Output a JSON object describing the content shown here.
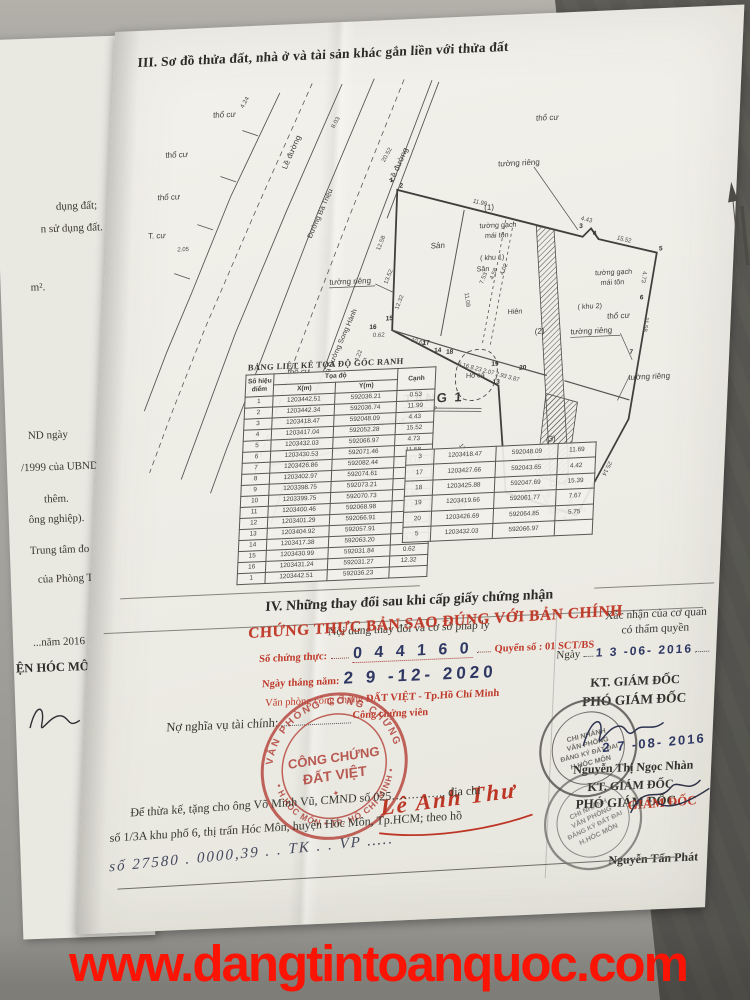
{
  "photo": {
    "watermark": "www.dangtintoanquoc.com"
  },
  "under_page": {
    "fragments": [
      "dụng đất;",
      "n sử dụng đất.",
      "m².",
      "ND ngày",
      "/1999 của UBND",
      "thêm.",
      "ông nghiệp).",
      "Trung tâm đo đạc",
      "của Phòng Tài",
      "...năm 2016",
      "ỆN HÓC MÔN"
    ]
  },
  "section3": {
    "title": "III. Sơ đồ thửa đất, nhà ở và tài sản khác gắn liền với thửa đất",
    "diagram": {
      "labels": {
        "tho_cu": "thổ cư",
        "t_cu": "T. cư",
        "le_duong": "Lề đường",
        "duong_ba_trieu": "Đường Bà Triệu",
        "ra_duong": "Ra Đường Song Hành",
        "san": "Sân",
        "hien": "Hiên",
        "ho_ca": "Hồ cá",
        "khu1_no": "(1)",
        "khu2_no": "(2)",
        "khu3_no": "(3)",
        "khu1": "( khu 1)",
        "khu2": "( khu 2)",
        "tuong_gach": "tường gạch",
        "mai_ton": "mái tôn",
        "tuong_rieng": "tường riêng",
        "tang1": "TẦNG 1"
      },
      "dims": [
        "4.24",
        "8.03",
        "20.52",
        "2.05",
        "11.99",
        "4.43",
        "15.52",
        "4.73",
        "11.58",
        "25.14",
        "12.58",
        "13.52",
        "12.32",
        "4.22",
        "10.62",
        "11.09",
        "7.53",
        "4.58",
        "4.02",
        "14.18",
        "13.54",
        "9.71",
        "0.62",
        "4.64",
        "2.23",
        "1.90",
        "2.67",
        "5.16 8.23 2.07 2.93 3.87"
      ],
      "points": [
        "1",
        "2",
        "3",
        "4",
        "5",
        "6",
        "7",
        "8",
        "9",
        "12",
        "13",
        "14",
        "15",
        "16",
        "17",
        "18",
        "19",
        "20"
      ]
    },
    "coords_table": {
      "title": "BẢNG LIỆT KÊ TỌA ĐỘ GỐC RANH",
      "col_point": "Số hiệu điểm",
      "col_coords": "Tọa độ",
      "col_x": "X(m)",
      "col_y": "Y(m)",
      "col_edge": "Cạnh",
      "rows": [
        [
          "1",
          "1203442.51",
          "592036.21",
          "0.53"
        ],
        [
          "2",
          "1203442.34",
          "592036.74",
          "11.99"
        ],
        [
          "3",
          "1203418.47",
          "592048.09",
          "4.43"
        ],
        [
          "4",
          "1203417.04",
          "592052.28",
          "15.52"
        ],
        [
          "5",
          "1203432.03",
          "592066.97",
          "4.73"
        ],
        [
          "6",
          "1203430.53",
          "592071.46",
          "11.58"
        ],
        [
          "7",
          "1203426.86",
          "592082.44",
          "25.14"
        ],
        [
          "8",
          "1203402.97",
          "592074.61",
          "4.64"
        ],
        [
          "9",
          "1203398.75",
          "592073.21",
          "2.67"
        ],
        [
          "10",
          "1203399.75",
          "592070.73",
          "1.90"
        ],
        [
          "11",
          "1203400.46",
          "592068.98",
          "2.23"
        ],
        [
          "12",
          "1203401.29",
          "592066.91",
          "9.71"
        ],
        [
          "13",
          "1203404.92",
          "592057.91",
          "13.54"
        ],
        [
          "14",
          "1203417.38",
          "592063.20",
          "14.18"
        ],
        [
          "15",
          "1203430.99",
          "592031.84",
          "0.62"
        ],
        [
          "16",
          "1203431.24",
          "592031.27",
          "12.32"
        ],
        [
          "1",
          "1203442.51",
          "592036.23",
          ""
        ]
      ],
      "rows2": [
        [
          "3",
          "1203418.47",
          "592048.09",
          "11.69"
        ],
        [
          "17",
          "1203427.66",
          "592043.65",
          "4.42"
        ],
        [
          "18",
          "1203425.88",
          "592047.69",
          "15.39"
        ],
        [
          "19",
          "1203419.66",
          "592061.77",
          "7.67"
        ],
        [
          "20",
          "1203426.69",
          "592064.85",
          "5.75"
        ],
        [
          "5",
          "1203432.03",
          "592066.97",
          ""
        ]
      ]
    }
  },
  "section4": {
    "title": "IV. Những thay đổi sau khi cấp giấy chứng nhận",
    "left_header": "Nội dung thay đổi và cơ sở pháp lý",
    "right_header_1": "Xác nhận của cơ quan",
    "right_header_2": "có thẩm quyền",
    "notary": {
      "line1": "CHỨNG THỰC BẢN SAO ĐÚNG VỚI BẢN CHÍNH",
      "so_ct_label": "Số chứng thực:",
      "so_ct_value": "0 4 4 1 6 0",
      "quyen_so": "Quyển số : 01 SCT/BS",
      "ngay_label": "Ngày tháng năm:",
      "ngay_value": "2 9  -12-  2020",
      "office_pre": "Văn phòng công chứng ",
      "office_bold": "ĐẤT VIỆT - Tp.Hồ Chí Minh",
      "ccv": "Công chứng viên",
      "stamp_arc_top": "VĂN PHÒNG CÔNG CHỨNG",
      "stamp_arc_bottom": "• H.HÓC MÔN • TP. HỒ CHÍ MINH •",
      "stamp_center1": "CÔNG CHỨNG",
      "stamp_center2": "ĐẤT VIỆT",
      "stamp_star": "✦",
      "signature_name": "Lê Anh Thư"
    },
    "finance_label": "Nợ nghĩa vụ tài chính:",
    "authority": {
      "date1_label": "Ngày",
      "date1_value": "1 3  -06-  2016",
      "kt_giam_doc": "KT. GIÁM ĐỐC",
      "pho_giam_doc": "PHÓ GIÁM ĐỐC",
      "stamp_lines": [
        "CHI NHÁNH",
        "VĂN PHÒNG",
        "ĐĂNG KÝ ĐẤT ĐAI",
        "H.HÓC MÔN"
      ],
      "date2_value": "2 7  -08-  2016",
      "name1": "Nguyễn Thị Ngọc Nhàn",
      "kt_giam_doc2": "KT. GIÁM ĐỐC",
      "pho_giam_doc2": "PHÓ GIÁM ĐỐC",
      "giam_doc_red": "GIÁM ĐỐC",
      "name2": "Nguyễn Tấn Phát"
    },
    "transfer_note_1": "Để thừa kế, tặng cho ông Võ Minh Vũ, CMND số 025…………., địa chỉ",
    "transfer_note_2": "số 1/3A khu phố 6, thị trấn Hóc Môn, huyện Hóc Môn, Tp.HCM; theo hồ",
    "transfer_note_3": "số  27580 . 0000,39 . . TK . . VP ….."
  }
}
